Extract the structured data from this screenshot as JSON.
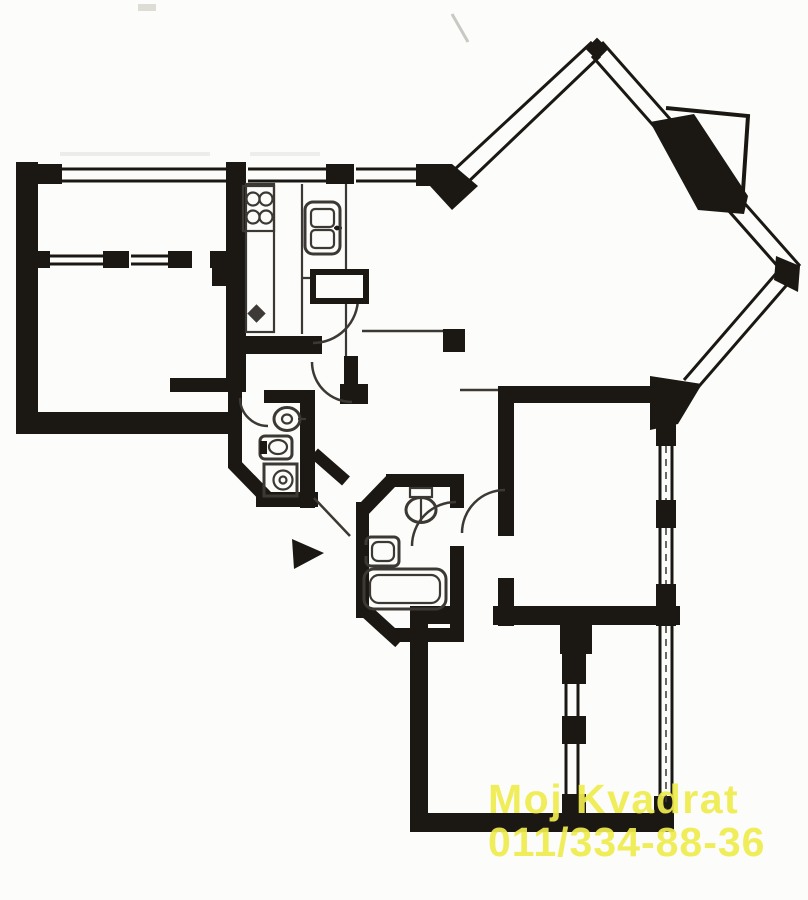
{
  "watermark": {
    "line1": "Moj Kvadrat",
    "line2": "011/334-88-36",
    "color": "#f0ec4e"
  },
  "palette": {
    "background": "#fcfcfa",
    "wall_color": "#1b1814",
    "line_color": "#3c3833",
    "watermark_color": "#f0ec4e"
  },
  "floor_plan": {
    "kind": "scanned black-and-white apartment floor plan",
    "symbols": {
      "kitchen": [
        "stove-4-burner",
        "counter-sink",
        "double-sink",
        "appliance-box"
      ],
      "wc": [
        "toilet",
        "bidet",
        "washing-machine"
      ],
      "bathroom": [
        "toilet",
        "washbasin",
        "bathtub"
      ],
      "other": [
        "entrance-arrow",
        "door-swing-arc",
        "window-double-line",
        "structural-column",
        "balcony-outline"
      ]
    }
  }
}
